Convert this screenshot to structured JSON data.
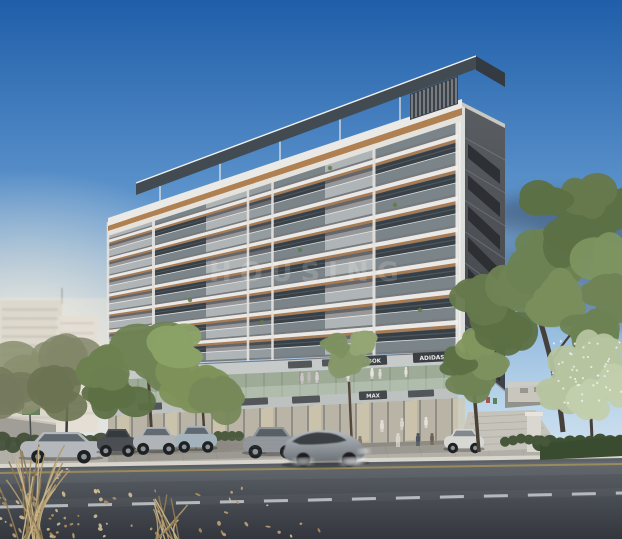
{
  "watermark": {
    "text": "HOUSING"
  },
  "building": {
    "floors_visible": 8
  },
  "storefront_signs": {
    "upper_band": [
      {
        "label": "REEBOK"
      },
      {
        "label": "ADIDAS"
      }
    ],
    "lower_band": [
      {
        "label": "MAX"
      }
    ]
  },
  "palette": {
    "sky_top": "#1f5ea9",
    "sky_mid": "#6ba0d4",
    "sky_horizon": "#e8f0f4",
    "sun_glow": "#fdf3e0",
    "cloud": "#3e4e63",
    "slab": "#ebe9e5",
    "wall": "#97979a",
    "wall_side": "#47494d",
    "glass": "#394147",
    "wood_soffit": "#a87a4e",
    "balustrade": "#ccd6da",
    "fascia": "#c6cac9",
    "sign_plate": "#3e4246",
    "sign_text": "#e8e9ea",
    "showcase_glass": "#9dab97",
    "sidewalk": "#b2afa7",
    "road": "#565b62",
    "lane_dash": "#cfd3d6",
    "curb_line": "#c9a94e",
    "foliage_dark": "#5c7045",
    "foliage_mid": "#6f8354",
    "foliage_light": "#8ba267",
    "blossom": "#b6c4a0",
    "trunk": "#4a4136",
    "dry_grass": "#c9b68c",
    "leaf_litter": "#c8a87a",
    "car_silver": "#b4b8bc",
    "moving_car": "#9aa0a6"
  }
}
